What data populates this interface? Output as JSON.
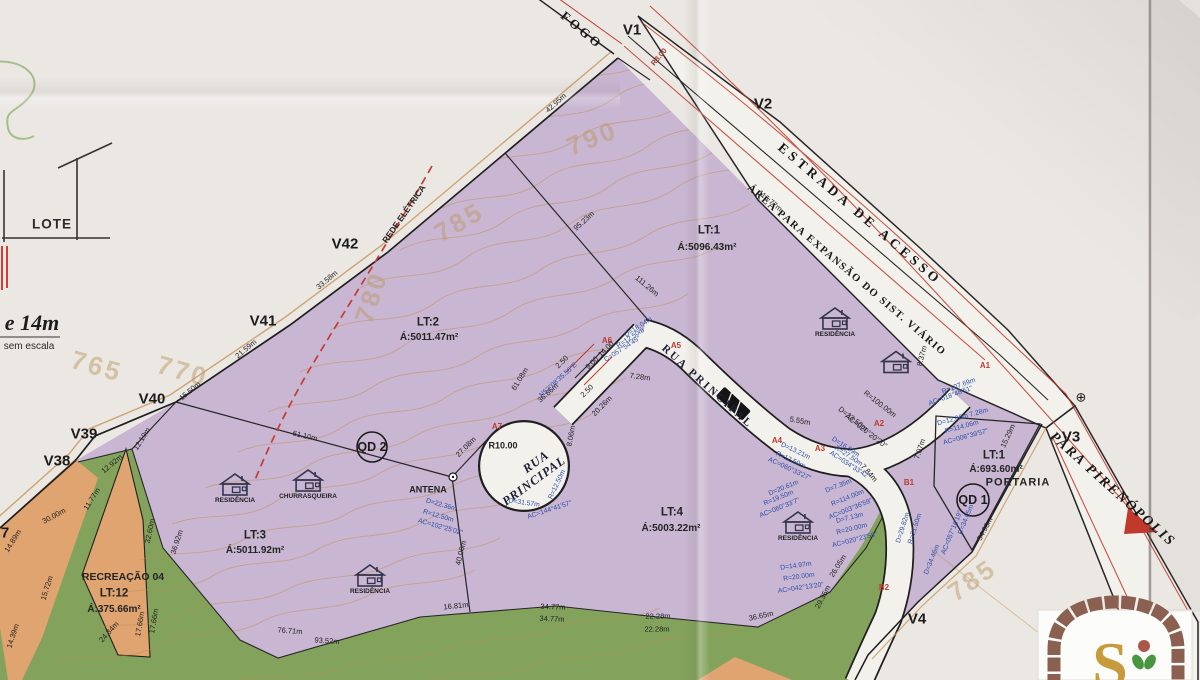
{
  "colors": {
    "purple": "#c9b6d2",
    "green": "#83a35c",
    "orange": "#e0a470",
    "paper": "#f3f1ec",
    "red": "#c0392b",
    "blue": "#2b4ea8",
    "tan": "#c89a5e",
    "ink": "#1f1f1f",
    "gold": "#c79b3c",
    "brick": "#8b6051"
  },
  "logo": {
    "letter": "S"
  },
  "map": {
    "houses": [
      {
        "x": 835,
        "y": 322,
        "label": "RESIDÊNCIA"
      },
      {
        "x": 896,
        "y": 362,
        "label": ""
      },
      {
        "x": 798,
        "y": 526,
        "label": "RESIDÊNCIA"
      },
      {
        "x": 235,
        "y": 488,
        "label": "RESIDÊNCIA"
      },
      {
        "x": 308,
        "y": 484,
        "label": "CHURRASQUEIRA"
      },
      {
        "x": 370,
        "y": 579,
        "label": "RESIDÊNCIA"
      }
    ],
    "labels": [
      {
        "t": "V1",
        "x": 632,
        "y": 30,
        "k": "v"
      },
      {
        "t": "V2",
        "x": 763,
        "y": 104,
        "k": "v"
      },
      {
        "t": "V3",
        "x": 1071,
        "y": 437,
        "k": "v"
      },
      {
        "t": "V4",
        "x": 917,
        "y": 619,
        "k": "v"
      },
      {
        "t": "V38",
        "x": 57,
        "y": 461,
        "k": "v"
      },
      {
        "t": "V39",
        "x": 84,
        "y": 434,
        "k": "v"
      },
      {
        "t": "V40",
        "x": 152,
        "y": 399,
        "k": "v"
      },
      {
        "t": "V41",
        "x": 263,
        "y": 321,
        "k": "v"
      },
      {
        "t": "V42",
        "x": 345,
        "y": 244,
        "k": "v"
      },
      {
        "t": "7",
        "x": 5,
        "y": 533,
        "k": "v"
      },
      {
        "t": "LT:1",
        "x": 709,
        "y": 231,
        "k": "lot"
      },
      {
        "t": "Á:5096.43m²",
        "x": 707,
        "y": 248,
        "k": "lota"
      },
      {
        "t": "LT:2",
        "x": 428,
        "y": 323,
        "k": "lot"
      },
      {
        "t": "Á:5011.47m²",
        "x": 429,
        "y": 338,
        "k": "lota"
      },
      {
        "t": "LT:3",
        "x": 255,
        "y": 536,
        "k": "lot"
      },
      {
        "t": "Á:5011.92m²",
        "x": 255,
        "y": 551,
        "k": "lota"
      },
      {
        "t": "LT:4",
        "x": 672,
        "y": 513,
        "k": "lot"
      },
      {
        "t": "Á:5003.22m²",
        "x": 671,
        "y": 529,
        "k": "lota"
      },
      {
        "t": "RECREAÇÃO 04",
        "x": 123,
        "y": 577,
        "k": "rec"
      },
      {
        "t": "LT:12",
        "x": 114,
        "y": 594,
        "k": "lot"
      },
      {
        "t": "Á:375.66m²",
        "x": 114,
        "y": 610,
        "k": "lota"
      },
      {
        "t": "LT:1",
        "x": 994,
        "y": 456,
        "k": "lot"
      },
      {
        "t": "Á:693.60m²",
        "x": 996,
        "y": 470,
        "k": "lota"
      },
      {
        "t": "PORTARIA",
        "x": 1018,
        "y": 483,
        "k": "port"
      },
      {
        "t": "FOGO",
        "x": 582,
        "y": 30,
        "r": 40,
        "k": "rdsm"
      },
      {
        "t": "ESTRADA DE ACESSO",
        "x": 860,
        "y": 214,
        "r": 40.5,
        "k": "rd1"
      },
      {
        "t": "ÁREA PARA EXPANSÃO DO SIST. VIÁRIO",
        "x": 846,
        "y": 271,
        "r": 40.5,
        "k": "rd2"
      },
      {
        "t": "PARA PIRENÓPOLIS",
        "x": 1112,
        "y": 490,
        "r": 42,
        "k": "pir"
      },
      {
        "t": "RUA",
        "x": 536,
        "y": 462,
        "r": -36,
        "k": "rua"
      },
      {
        "t": "PRINCIPAL",
        "x": 534,
        "y": 481,
        "r": -36,
        "k": "rua"
      },
      {
        "t": "RUA PRINCIPAL",
        "x": 707,
        "y": 387,
        "r": 42,
        "k": "rua2"
      },
      {
        "t": "REDE ELÉTRICA",
        "x": 404,
        "y": 214,
        "r": -55,
        "k": "rede"
      },
      {
        "t": "ANTENA",
        "x": 428,
        "y": 490,
        "k": "ant"
      },
      {
        "t": "QD 2",
        "x": 372,
        "y": 447,
        "k": "qd"
      },
      {
        "t": "QD 1",
        "x": 973,
        "y": 500,
        "k": "qd"
      },
      {
        "t": "⊕",
        "x": 1081,
        "y": 397,
        "k": "sym"
      },
      {
        "t": "LOTE",
        "x": 52,
        "y": 224,
        "k": "legend"
      },
      {
        "t": "e 14m",
        "x": 32,
        "y": 323,
        "k": "n14"
      },
      {
        "t": "sem escala",
        "x": 29,
        "y": 347,
        "k": "nsc"
      },
      {
        "t": "790",
        "x": 592,
        "y": 138,
        "r": -22,
        "k": "c"
      },
      {
        "t": "785",
        "x": 459,
        "y": 222,
        "r": -30,
        "k": "c"
      },
      {
        "t": "780",
        "x": 371,
        "y": 297,
        "r": -72,
        "k": "c"
      },
      {
        "t": "770",
        "x": 183,
        "y": 371,
        "r": 16,
        "k": "c"
      },
      {
        "t": "765",
        "x": 97,
        "y": 366,
        "r": 16,
        "k": "c"
      },
      {
        "t": "785",
        "x": 972,
        "y": 580,
        "r": -35,
        "k": "c"
      },
      {
        "t": "A1",
        "x": 985,
        "y": 366,
        "k": "r"
      },
      {
        "t": "A2",
        "x": 879,
        "y": 424,
        "k": "r"
      },
      {
        "t": "A3",
        "x": 820,
        "y": 449,
        "k": "r"
      },
      {
        "t": "A4",
        "x": 777,
        "y": 441,
        "k": "r"
      },
      {
        "t": "A5",
        "x": 676,
        "y": 346,
        "k": "r"
      },
      {
        "t": "A6",
        "x": 607,
        "y": 341,
        "k": "r"
      },
      {
        "t": "A7",
        "x": 497,
        "y": 427,
        "k": "r"
      },
      {
        "t": "B1",
        "x": 909,
        "y": 483,
        "k": "r"
      },
      {
        "t": "B2",
        "x": 884,
        "y": 588,
        "k": "r"
      },
      {
        "t": "R8.00",
        "x": 659,
        "y": 57,
        "r": -50,
        "k": "mr"
      },
      {
        "t": "42.95m",
        "x": 556,
        "y": 103,
        "r": -42,
        "k": "m"
      },
      {
        "t": "95.23m",
        "x": 584,
        "y": 221,
        "r": -42,
        "k": "m"
      },
      {
        "t": "116.77m",
        "x": 770,
        "y": 201,
        "r": 40,
        "k": "m"
      },
      {
        "t": "111.26m",
        "x": 647,
        "y": 286,
        "r": 40,
        "k": "m"
      },
      {
        "t": "33.58m",
        "x": 327,
        "y": 280,
        "r": -40,
        "k": "m"
      },
      {
        "t": "21.59m",
        "x": 246,
        "y": 349,
        "r": -40,
        "k": "m"
      },
      {
        "t": "15.50m",
        "x": 190,
        "y": 391,
        "r": -40,
        "k": "m"
      },
      {
        "t": "12.19m",
        "x": 142,
        "y": 439,
        "r": -58,
        "k": "m"
      },
      {
        "t": "12.92m",
        "x": 112,
        "y": 464,
        "r": -40,
        "k": "m"
      },
      {
        "t": "11.77m",
        "x": 92,
        "y": 499,
        "r": -58,
        "k": "m"
      },
      {
        "t": "30.00m",
        "x": 54,
        "y": 516,
        "r": -28,
        "k": "m"
      },
      {
        "t": "14.89m",
        "x": 13,
        "y": 541,
        "r": -58,
        "k": "m"
      },
      {
        "t": "15.72m",
        "x": 47,
        "y": 588,
        "r": -72,
        "k": "m"
      },
      {
        "t": "14.39m",
        "x": 13,
        "y": 636,
        "r": -72,
        "k": "m"
      },
      {
        "t": "61.10m",
        "x": 305,
        "y": 436,
        "r": 13,
        "k": "m"
      },
      {
        "t": "27.08m",
        "x": 466,
        "y": 447,
        "r": -45,
        "k": "m"
      },
      {
        "t": "40.06m",
        "x": 461,
        "y": 553,
        "r": -76,
        "k": "m"
      },
      {
        "t": "36.92m",
        "x": 177,
        "y": 542,
        "r": -72,
        "k": "m"
      },
      {
        "t": "32.60m",
        "x": 150,
        "y": 531,
        "r": -78,
        "k": "m"
      },
      {
        "t": "17.66m",
        "x": 140,
        "y": 624,
        "r": -80,
        "k": "m"
      },
      {
        "t": "17.66m",
        "x": 154,
        "y": 621,
        "r": -80,
        "k": "m"
      },
      {
        "t": "24.34m",
        "x": 109,
        "y": 632,
        "r": -48,
        "k": "m"
      },
      {
        "t": "76.71m",
        "x": 290,
        "y": 631,
        "r": 4,
        "k": "m"
      },
      {
        "t": "93.52m",
        "x": 327,
        "y": 641,
        "r": 4,
        "k": "m"
      },
      {
        "t": "16.81m",
        "x": 456,
        "y": 606,
        "r": -6,
        "k": "m"
      },
      {
        "t": "34.77m",
        "x": 553,
        "y": 607,
        "r": 2,
        "k": "m"
      },
      {
        "t": "34.77m",
        "x": 552,
        "y": 619,
        "r": 2,
        "k": "m"
      },
      {
        "t": "22.28m",
        "x": 658,
        "y": 616,
        "k": "m"
      },
      {
        "t": "22.28m",
        "x": 657,
        "y": 629,
        "k": "m"
      },
      {
        "t": "36.65m",
        "x": 761,
        "y": 616,
        "r": -12,
        "k": "m"
      },
      {
        "t": "26.05m",
        "x": 838,
        "y": 566,
        "r": -58,
        "k": "m"
      },
      {
        "t": "29.35m",
        "x": 823,
        "y": 597,
        "r": -62,
        "k": "m"
      },
      {
        "t": "54.98m",
        "x": 985,
        "y": 529,
        "r": -62,
        "k": "m"
      },
      {
        "t": "15.29m",
        "x": 1008,
        "y": 436,
        "r": -65,
        "k": "m"
      },
      {
        "t": "7.07m",
        "x": 920,
        "y": 449,
        "r": -72,
        "k": "m"
      },
      {
        "t": "8.37m",
        "x": 922,
        "y": 356,
        "r": -75,
        "k": "m"
      },
      {
        "t": "5.55m",
        "x": 800,
        "y": 421,
        "r": 10,
        "k": "m"
      },
      {
        "t": "7.28m",
        "x": 640,
        "y": 377,
        "r": 8,
        "k": "m"
      },
      {
        "t": "20.26m",
        "x": 602,
        "y": 406,
        "r": -45,
        "k": "m"
      },
      {
        "t": "2.50",
        "x": 562,
        "y": 362,
        "r": -45,
        "k": "m"
      },
      {
        "t": "9.00",
        "x": 592,
        "y": 363,
        "r": -45,
        "k": "m"
      },
      {
        "t": "14.00",
        "x": 606,
        "y": 349,
        "r": -45,
        "k": "m"
      },
      {
        "t": "2.50",
        "x": 587,
        "y": 391,
        "r": -45,
        "k": "m"
      },
      {
        "t": "36.66m",
        "x": 548,
        "y": 393,
        "r": -42,
        "k": "m"
      },
      {
        "t": "61.08m",
        "x": 520,
        "y": 379,
        "r": -58,
        "k": "m"
      },
      {
        "t": "8.06m",
        "x": 571,
        "y": 436,
        "r": -80,
        "k": "m"
      },
      {
        "t": "R10.00",
        "x": 503,
        "y": 446,
        "k": "m9"
      },
      {
        "t": "7.84m",
        "x": 869,
        "y": 473,
        "r": 48,
        "k": "m"
      },
      {
        "t": "R=100.00m",
        "x": 880,
        "y": 404,
        "r": 38,
        "k": "m"
      },
      {
        "t": "D=33.50m",
        "x": 853,
        "y": 419,
        "r": 38,
        "k": "m"
      },
      {
        "t": "AC=020°20'20\"",
        "x": 866,
        "y": 431,
        "r": 38,
        "k": "m"
      },
      {
        "t": "N52°08'35.56\"E",
        "x": 559,
        "y": 381,
        "r": -42,
        "k": "b"
      },
      {
        "t": "D=18.04m",
        "x": 639,
        "y": 328,
        "r": -33,
        "k": "b"
      },
      {
        "t": "R=12.50m",
        "x": 631,
        "y": 339,
        "r": -33,
        "k": "b"
      },
      {
        "t": "C=057°54'45\"",
        "x": 623,
        "y": 350,
        "r": -33,
        "k": "b"
      },
      {
        "t": "D=16.59m",
        "x": 845,
        "y": 448,
        "r": 33,
        "k": "b"
      },
      {
        "t": "R=27.50m",
        "x": 848,
        "y": 457,
        "r": 33,
        "k": "b"
      },
      {
        "t": "AC=034°33'42\"",
        "x": 849,
        "y": 466,
        "r": 33,
        "k": "b"
      },
      {
        "t": "D=13.21m",
        "x": 795,
        "y": 452,
        "r": 25,
        "k": "b"
      },
      {
        "t": "R=12.50m",
        "x": 790,
        "y": 461,
        "r": 25,
        "k": "b"
      },
      {
        "t": "AC=060°33'27\"",
        "x": 789,
        "y": 470,
        "r": 25,
        "k": "b"
      },
      {
        "t": "D=20.61m",
        "x": 784,
        "y": 489,
        "r": -22,
        "k": "b"
      },
      {
        "t": "R=19.50m",
        "x": 779,
        "y": 499,
        "r": -22,
        "k": "b"
      },
      {
        "t": "AC=060°33'7\"",
        "x": 780,
        "y": 509,
        "r": -22,
        "k": "b"
      },
      {
        "t": "D=7.35m",
        "x": 839,
        "y": 487,
        "r": -22,
        "k": "b"
      },
      {
        "t": "R=114.00m",
        "x": 848,
        "y": 499,
        "r": -22,
        "k": "b"
      },
      {
        "t": "AC=003°36'59\"",
        "x": 851,
        "y": 510,
        "r": -22,
        "k": "b"
      },
      {
        "t": "D=7.13m",
        "x": 850,
        "y": 519,
        "r": -14,
        "k": "b"
      },
      {
        "t": "R=20.00m",
        "x": 852,
        "y": 530,
        "r": -14,
        "k": "b"
      },
      {
        "t": "AC=020°23'58\"",
        "x": 855,
        "y": 541,
        "r": -14,
        "k": "b"
      },
      {
        "t": "D=14.97m",
        "x": 796,
        "y": 567,
        "r": -8,
        "k": "b"
      },
      {
        "t": "R=20.00m",
        "x": 799,
        "y": 578,
        "r": -8,
        "k": "b"
      },
      {
        "t": "AC=042°13'20\"",
        "x": 801,
        "y": 589,
        "r": -8,
        "k": "b"
      },
      {
        "t": "D=22.36m",
        "x": 441,
        "y": 506,
        "r": 16,
        "k": "b"
      },
      {
        "t": "R=12.50m",
        "x": 438,
        "y": 517,
        "r": 16,
        "k": "b"
      },
      {
        "t": "AC=102°25'02\"",
        "x": 440,
        "y": 528,
        "r": 16,
        "k": "b"
      },
      {
        "t": "D=31.57m",
        "x": 524,
        "y": 504,
        "r": 8,
        "k": "b"
      },
      {
        "t": "AC=144°41'57\"",
        "x": 550,
        "y": 511,
        "r": -18,
        "k": "b"
      },
      {
        "t": "R=12.50m",
        "x": 558,
        "y": 485,
        "r": -65,
        "k": "b"
      },
      {
        "t": "R=107.69m",
        "x": 959,
        "y": 387,
        "r": -20,
        "k": "b"
      },
      {
        "t": "AC=018°48'51\"",
        "x": 951,
        "y": 397,
        "r": -20,
        "k": "b"
      },
      {
        "t": "D=12.06m 7.28m",
        "x": 963,
        "y": 418,
        "r": -15,
        "k": "b"
      },
      {
        "t": "R=114.06m",
        "x": 962,
        "y": 428,
        "r": -15,
        "k": "b"
      },
      {
        "t": "AC=006°39'57\"",
        "x": 966,
        "y": 438,
        "r": -15,
        "k": "b"
      },
      {
        "t": "D=34.46m",
        "x": 933,
        "y": 560,
        "r": -68,
        "k": "b"
      },
      {
        "t": "R=34.05m",
        "x": 967,
        "y": 520,
        "r": -68,
        "k": "b"
      },
      {
        "t": "AC=057°16'19\"",
        "x": 953,
        "y": 533,
        "r": -68,
        "k": "b"
      },
      {
        "t": "D=29.82m",
        "x": 904,
        "y": 528,
        "r": -72,
        "k": "b"
      },
      {
        "t": "R=21.50m",
        "x": 916,
        "y": 529,
        "r": -72,
        "k": "b"
      }
    ]
  }
}
